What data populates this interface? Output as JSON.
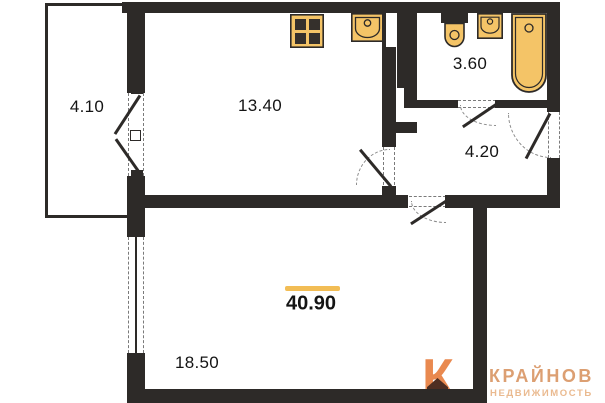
{
  "plan": {
    "title": "one-room apartment floor plan",
    "rooms": [
      {
        "name": "balcony",
        "area": "4.10"
      },
      {
        "name": "kitchen",
        "area": "13.40"
      },
      {
        "name": "bathroom",
        "area": "3.60"
      },
      {
        "name": "hallway",
        "area": "4.20"
      },
      {
        "name": "living-room",
        "area": "18.50"
      }
    ],
    "total_area": "40.90",
    "fixtures": [
      "stove-icon",
      "kitchen-sink-icon",
      "toilet-icon",
      "washbasin-icon",
      "bathtub-icon"
    ],
    "colors": {
      "wall": "#2d2a28",
      "fixture_fill": "#f4c467",
      "fixture_stroke": "#2d2a28",
      "accent_line": "#f2bd55",
      "logo_mark": "#e9894f",
      "logo_house": "#4e2e22",
      "logo_brand": "#dc9f72",
      "logo_tagline": "#eaba90"
    }
  },
  "logo": {
    "brand": "КРАЙНОВ",
    "tagline": "НЕДВИЖИМОСТЬ"
  }
}
